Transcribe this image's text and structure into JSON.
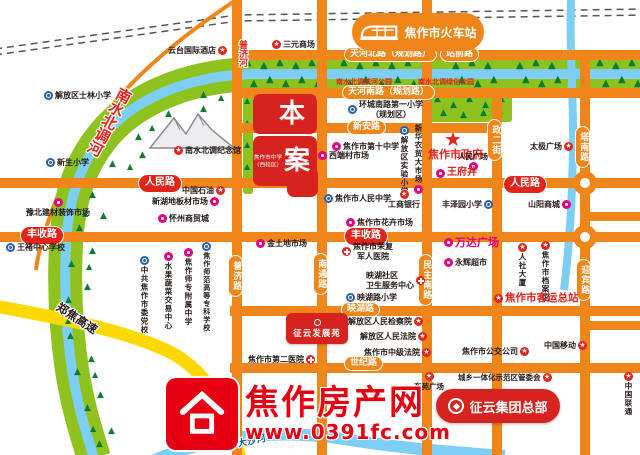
{
  "map": {
    "station": {
      "label": "焦作市火车站"
    },
    "project": {
      "char1": "本",
      "char2": "案",
      "note_line1": "焦作市中学",
      "note_line2": "（西校区）"
    },
    "banners": {
      "development": "征云发展苑",
      "headquarters": "征云集团总部"
    },
    "watermark": {
      "title": "焦作房产网",
      "url": "www.0391fc.com"
    },
    "colors": {
      "road": "#F08519",
      "accent_red": "#E2241B",
      "green": "#8DC21F",
      "water": "#7DCEF4",
      "magenta": "#E4007F",
      "school_blue": "#2B5FAC",
      "expressway_yellow": "#FFD800",
      "watermark_red": "#E60012"
    },
    "road_labels": [
      {
        "text": "天河北路（规划路）",
        "x": 344,
        "y": 47,
        "v": 0,
        "style": "orange"
      },
      {
        "text": "站前路",
        "x": 440,
        "y": 47,
        "v": 0,
        "style": "orange"
      },
      {
        "text": "天河南路（规划路）",
        "x": 342,
        "y": 85,
        "v": 0,
        "style": "orange"
      },
      {
        "text": "新安路",
        "x": 347,
        "y": 120,
        "v": 0,
        "style": "orange"
      },
      {
        "text": "人民路",
        "x": 138,
        "y": 174,
        "v": 0,
        "style": "red"
      },
      {
        "text": "人民路",
        "x": 503,
        "y": 175,
        "v": 0,
        "style": "red"
      },
      {
        "text": "丰收路",
        "x": 20,
        "y": 226,
        "v": 0,
        "style": "red"
      },
      {
        "text": "丰收路",
        "x": 344,
        "y": 227,
        "v": 0,
        "style": "red"
      },
      {
        "text": "映湖路",
        "x": 341,
        "y": 302,
        "v": 0,
        "style": "orange"
      },
      {
        "text": "世纪路",
        "x": 344,
        "y": 356,
        "v": 0,
        "style": "orange"
      },
      {
        "text": "普济路",
        "x": 228,
        "y": 255,
        "v": 1,
        "style": "orange"
      },
      {
        "text": "南通路",
        "x": 313,
        "y": 253,
        "v": 1,
        "style": "orange"
      },
      {
        "text": "民主南路",
        "x": 418,
        "y": 254,
        "v": 1,
        "style": "orange"
      },
      {
        "text": "政二街",
        "x": 487,
        "y": 119,
        "v": 1,
        "style": "orange"
      },
      {
        "text": "塔南路",
        "x": 575,
        "y": 126,
        "v": 1,
        "style": "orange"
      },
      {
        "text": "迎宾路",
        "x": 576,
        "y": 259,
        "v": 1,
        "style": "orange"
      }
    ],
    "pois": [
      {
        "t": "云台国际酒店",
        "x": 168,
        "y": 46,
        "icon": "gov",
        "ip": "r"
      },
      {
        "t": "三元商场",
        "x": 272,
        "y": 40,
        "icon": "gov",
        "ip": "l"
      },
      {
        "t": "解放区士林小学",
        "x": 44,
        "y": 91,
        "icon": "school",
        "ip": "l"
      },
      {
        "t": "环城南路第一小学",
        "l2": "（规划区）",
        "x": 348,
        "y": 100,
        "icon": "school",
        "ip": "l"
      },
      {
        "t": "南水北调滨河公园",
        "x": 336,
        "y": 78,
        "col": "red",
        "fs": 7,
        "icon": "none"
      },
      {
        "t": "南水北调绿化公园",
        "x": 418,
        "y": 78,
        "col": "red",
        "fs": 7,
        "icon": "none"
      },
      {
        "t": "新生小学",
        "x": 46,
        "y": 158,
        "icon": "school",
        "ip": "l"
      },
      {
        "t": "南水北调纪念馆",
        "x": 174,
        "y": 146,
        "icon": "gov",
        "ip": "l"
      },
      {
        "t": "焦作市第十中学",
        "x": 332,
        "y": 142,
        "icon": "market",
        "ip": "l"
      },
      {
        "t": "西端村市场",
        "x": 318,
        "y": 151,
        "icon": "market",
        "ip": "l"
      },
      {
        "t": "解放区实验小学",
        "x": 400,
        "y": 126,
        "vert": 1,
        "icon": "school",
        "ip": "t",
        "fs": 7.5
      },
      {
        "t": "新华农贸大市场",
        "x": 414,
        "y": 124,
        "vert": 1,
        "icon": "market",
        "ip": "b",
        "fs": 7.5
      },
      {
        "t": "焦作市政府",
        "x": 428,
        "y": 148,
        "col": "red",
        "fs": 11,
        "icon": "none"
      },
      {
        "t": "人民广场",
        "x": 458,
        "y": 152,
        "fs": 7.5,
        "icon": "market",
        "ip": "b"
      },
      {
        "t": "王府井",
        "x": 436,
        "y": 167,
        "col": "red",
        "fs": 10,
        "icon": "market",
        "ip": "l"
      },
      {
        "t": "太极广场",
        "x": 530,
        "y": 142,
        "icon": "gov",
        "ip": "r"
      },
      {
        "t": "丰泽园小学",
        "x": 442,
        "y": 200,
        "icon": "school",
        "ip": "r"
      },
      {
        "t": "山阳商城",
        "x": 528,
        "y": 200,
        "icon": "market",
        "ip": "r"
      },
      {
        "t": "焦作市人民中学",
        "x": 324,
        "y": 194,
        "icon": "school",
        "ip": "l"
      },
      {
        "t": "工商银行",
        "x": 388,
        "y": 190,
        "icon": "gov",
        "ip": "t"
      },
      {
        "t": "焦作市花卉市场",
        "x": 346,
        "y": 218,
        "icon": "market",
        "ip": "l"
      },
      {
        "t": "中国石油",
        "x": 182,
        "y": 186,
        "icon": "gov",
        "ip": "r"
      },
      {
        "t": "新湖地板材市场",
        "x": 152,
        "y": 197,
        "icon": "market",
        "ip": "r"
      },
      {
        "t": "怀州商贸城",
        "x": 158,
        "y": 214,
        "icon": "market",
        "ip": "l"
      },
      {
        "t": "豫北建材装饰市场",
        "x": 26,
        "y": 198,
        "icon": "market",
        "ip": "t"
      },
      {
        "t": "王褚中心学校",
        "x": 6,
        "y": 243,
        "icon": "school",
        "ip": "l"
      },
      {
        "t": "中共焦作市委党校",
        "x": 140,
        "y": 256,
        "vert": 1,
        "icon": "school",
        "ip": "t",
        "fs": 7.5
      },
      {
        "t": "水果蔬菜交易中心",
        "x": 164,
        "y": 252,
        "vert": 1,
        "icon": "market",
        "ip": "t",
        "fs": 7.5
      },
      {
        "t": "焦作师专附属中学",
        "x": 184,
        "y": 248,
        "vert": 1,
        "icon": "market",
        "ip": "t",
        "fs": 7.5
      },
      {
        "t": "焦作师范高等专科学校",
        "x": 202,
        "y": 242,
        "vert": 1,
        "icon": "school",
        "ip": "t",
        "fs": 7
      },
      {
        "t": "金土地市场",
        "x": 256,
        "y": 239,
        "icon": "market",
        "ip": "l"
      },
      {
        "t": "焦作市荣复",
        "l2": "军人医院",
        "x": 342,
        "y": 242,
        "icon": "hospital",
        "ip": "l"
      },
      {
        "t": "映湖社区",
        "l2": "卫生服务中心",
        "x": 366,
        "y": 271,
        "icon": "hospital",
        "ip": "r"
      },
      {
        "t": "映湖路小学",
        "x": 346,
        "y": 293,
        "icon": "school",
        "ip": "l"
      },
      {
        "t": "解放区人民检察院",
        "x": 348,
        "y": 317,
        "icon": "gov",
        "ip": "r"
      },
      {
        "t": "解放区人民法院",
        "x": 360,
        "y": 332,
        "icon": "gov",
        "ip": "r"
      },
      {
        "t": "焦作市中级法院",
        "x": 364,
        "y": 348,
        "icon": "gov",
        "ip": "r"
      },
      {
        "t": "焦作市第二医院",
        "x": 248,
        "y": 355,
        "icon": "hospital",
        "ip": "r"
      },
      {
        "t": "万达广场",
        "x": 444,
        "y": 236,
        "col": "mag",
        "fs": 11,
        "icon": "market",
        "ip": "l"
      },
      {
        "t": "永辉超市",
        "x": 444,
        "y": 258,
        "icon": "market",
        "ip": "l"
      },
      {
        "t": "人社大厦",
        "x": 518,
        "y": 243,
        "vert": 1,
        "icon": "gov",
        "ip": "t",
        "fs": 7.5
      },
      {
        "t": "焦作市档案馆",
        "x": 541,
        "y": 241,
        "vert": 1,
        "icon": "gov",
        "ip": "t",
        "fs": 7.5
      },
      {
        "t": "焦作市客运总站",
        "x": 494,
        "y": 292,
        "col": "red",
        "fs": 10.5,
        "icon": "gov",
        "ip": "l"
      },
      {
        "t": "焦作市公交公司",
        "x": 462,
        "y": 347,
        "icon": "gov",
        "ip": "r"
      },
      {
        "t": "中国移动",
        "x": 544,
        "y": 341,
        "icon": "gov",
        "ip": "r"
      },
      {
        "t": "城乡一体化示范区管委会",
        "x": 458,
        "y": 373,
        "icon": "gov",
        "ip": "r",
        "fs": 7.5
      },
      {
        "t": "中国联通",
        "x": 624,
        "y": 372,
        "vert": 1,
        "icon": "gov",
        "ip": "t",
        "fs": 7.5
      },
      {
        "t": "东苑广场",
        "x": 414,
        "y": 372,
        "icon": "gov",
        "ip": "t",
        "fs": 7.5
      }
    ],
    "rotated_labels": [
      {
        "text": "南水北调河",
        "x": 118,
        "y": 84,
        "rot": 28,
        "mode": "v",
        "color": "#E2241B",
        "fs": 15
      },
      {
        "text": "普济河",
        "x": 236,
        "y": 40,
        "rot": 0,
        "mode": "v",
        "color": "#E2241B",
        "fs": 9
      },
      {
        "text": "郑焦高速",
        "x": 62,
        "y": 299,
        "rot": 33,
        "mode": "h",
        "color": "#231815",
        "fs": 11.5
      },
      {
        "text": "大沙河",
        "x": 236,
        "y": 436,
        "rot": -12,
        "mode": "h",
        "color": "#0D5C8F",
        "fs": 9.5
      }
    ],
    "roads": {
      "vertical": [
        [
          232,
          0,
          10,
          455
        ],
        [
          317,
          0,
          10,
          455
        ],
        [
          422,
          0,
          10,
          455
        ],
        [
          492,
          93,
          10,
          362
        ],
        [
          580,
          57,
          10,
          398
        ]
      ],
      "horizontal": [
        [
          237,
          50,
          403,
          10
        ],
        [
          237,
          88,
          403,
          10
        ],
        [
          237,
          123,
          260,
          10
        ],
        [
          0,
          178,
          640,
          10
        ],
        [
          0,
          232,
          640,
          10
        ],
        [
          230,
          306,
          410,
          10
        ],
        [
          230,
          363,
          410,
          10
        ],
        [
          585,
          212,
          55,
          9
        ],
        [
          585,
          321,
          55,
          9
        ]
      ],
      "roundabouts": [
        [
          585,
          183
        ],
        [
          585,
          237
        ]
      ]
    }
  }
}
